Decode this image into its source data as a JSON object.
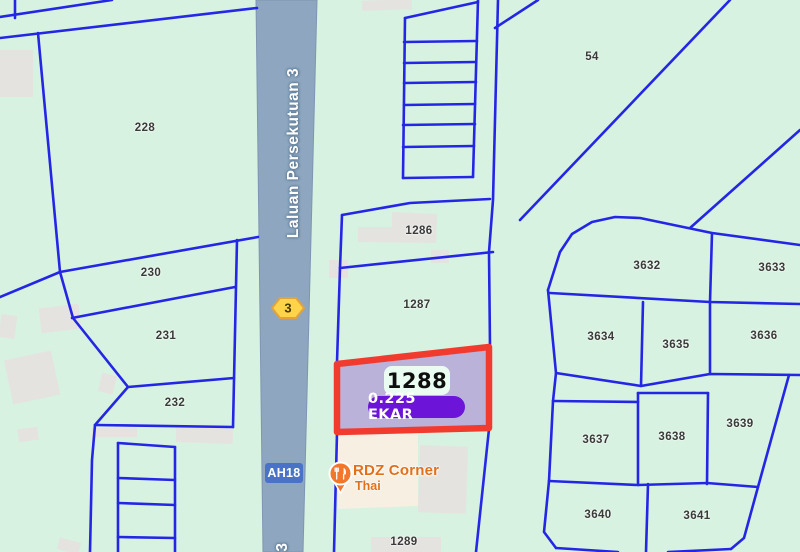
{
  "map": {
    "road": {
      "name_label": "Laluan Persekutuan 3",
      "route_shield": "3",
      "route_code": "AH18",
      "bottom_label": "3"
    },
    "highlight": {
      "lot": "1288",
      "area": "0.225 EKAR"
    },
    "poi": {
      "name": "RDZ Corner",
      "subtitle": "Thai",
      "icon": "restaurant-icon"
    },
    "parcels": [
      {
        "label": "228",
        "x": 145,
        "y": 128
      },
      {
        "label": "230",
        "x": 151,
        "y": 273
      },
      {
        "label": "231",
        "x": 166,
        "y": 336
      },
      {
        "label": "232",
        "x": 175,
        "y": 403
      },
      {
        "label": "54",
        "x": 592,
        "y": 57
      },
      {
        "label": "1286",
        "x": 419,
        "y": 231
      },
      {
        "label": "1287",
        "x": 417,
        "y": 305
      },
      {
        "label": "1289",
        "x": 404,
        "y": 542
      },
      {
        "label": "3632",
        "x": 647,
        "y": 266
      },
      {
        "label": "3633",
        "x": 772,
        "y": 268
      },
      {
        "label": "3634",
        "x": 601,
        "y": 337
      },
      {
        "label": "3635",
        "x": 676,
        "y": 345
      },
      {
        "label": "3636",
        "x": 764,
        "y": 336
      },
      {
        "label": "3637",
        "x": 596,
        "y": 440
      },
      {
        "label": "3638",
        "x": 672,
        "y": 437
      },
      {
        "label": "3639",
        "x": 740,
        "y": 424
      },
      {
        "label": "3640",
        "x": 598,
        "y": 515
      },
      {
        "label": "3641",
        "x": 697,
        "y": 516
      }
    ],
    "colors": {
      "background": "#D7F2E0",
      "boundary_blue": "#1B1CE6",
      "road_fill": "#8EA6C0",
      "highlight_border": "#F23B2F",
      "highlight_fill": "#B7ACD7",
      "lot_badge_bg": "#EAFBF1",
      "area_badge_bg": "#6C14D8",
      "shield_yellow": "#FFD34A",
      "route_code_bg": "#4A73C8",
      "poi_orange": "#E2701A",
      "building_gray": "#E4E3E0",
      "commercial_cream": "#F6EFE2"
    }
  }
}
